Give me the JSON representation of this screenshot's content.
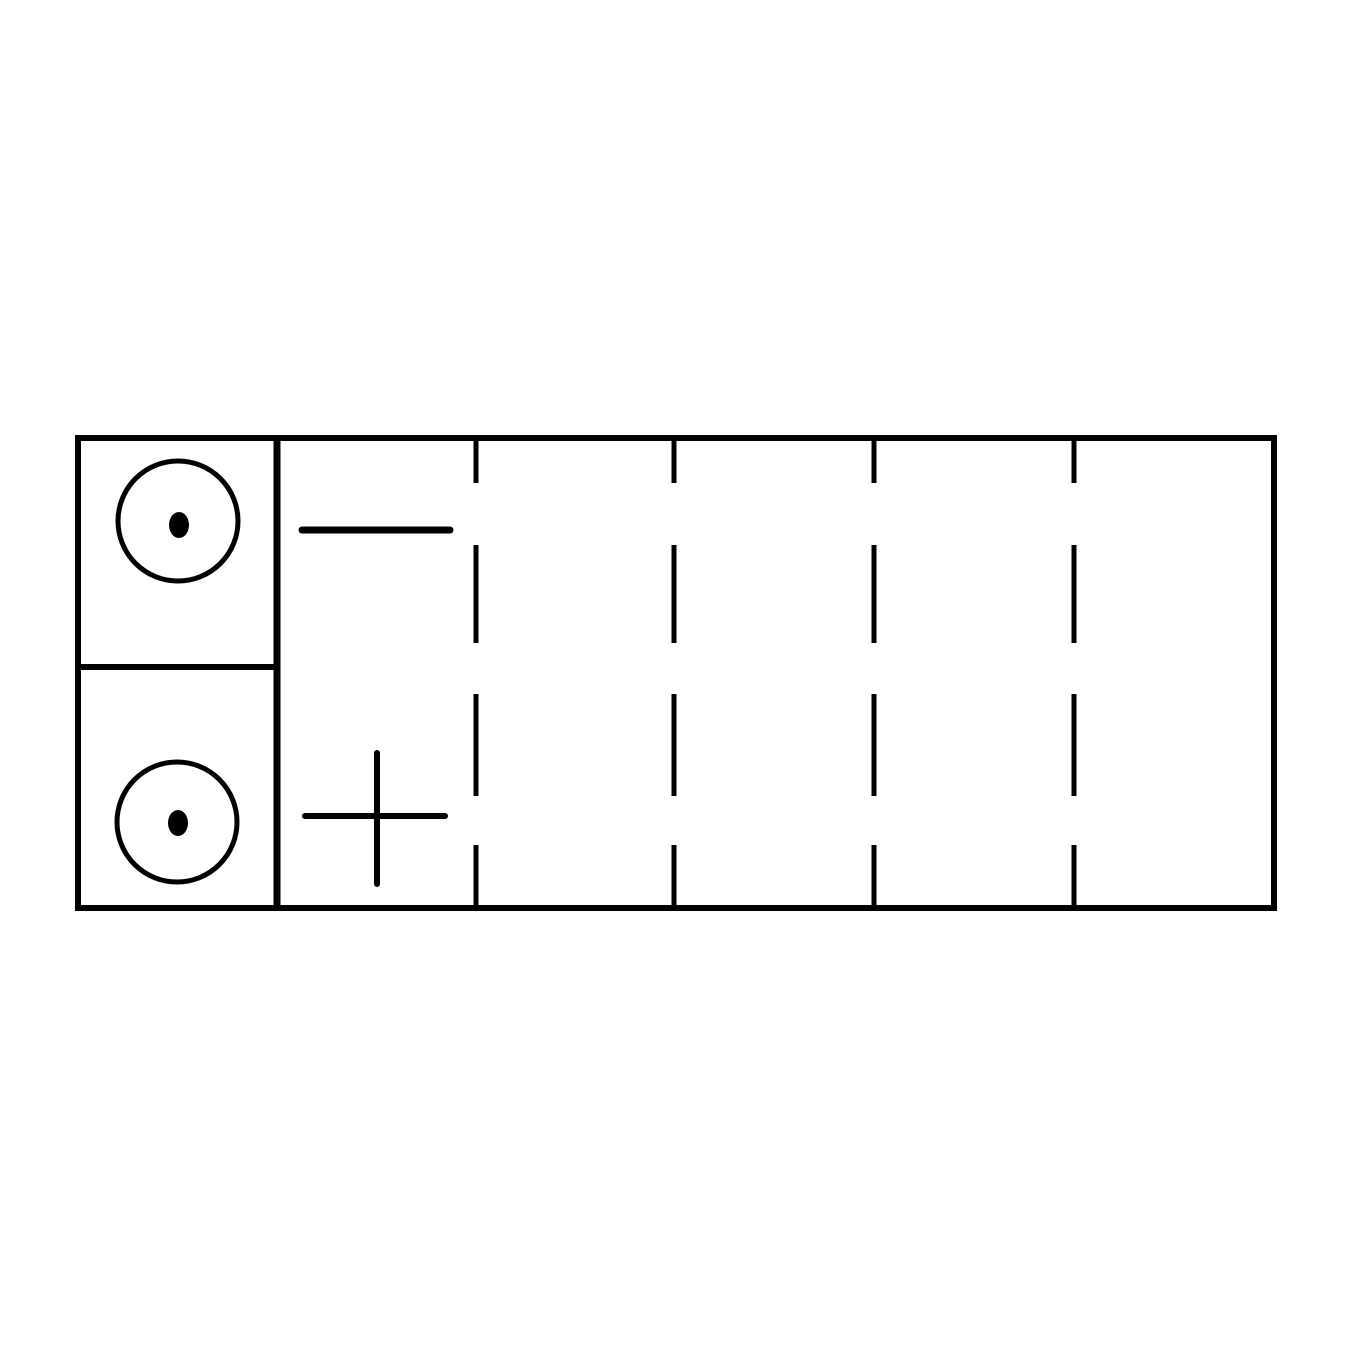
{
  "page": {
    "background_color": "#ffffff",
    "ink_color": "#000000"
  },
  "diagram": {
    "type": "battery-top-view-line-drawing",
    "canvas": {
      "width": 1350,
      "height": 1350
    },
    "outline": {
      "x": 78,
      "y": 438,
      "width": 1196,
      "height": 470,
      "stroke_width": 6
    },
    "terminal_block": {
      "right_edge_x": 277,
      "right_edge_stroke_width": 7,
      "divider_y": 667,
      "divider_stroke_width": 6
    },
    "terminals": [
      {
        "name": "negative-terminal",
        "polarity": "negative",
        "cx": 178,
        "cy": 521,
        "radius": 60,
        "stroke_width": 5,
        "dot_cx": 179,
        "dot_cy": 525,
        "dot_rx": 10,
        "dot_ry": 13
      },
      {
        "name": "positive-terminal",
        "polarity": "positive",
        "cx": 177,
        "cy": 822,
        "radius": 60,
        "stroke_width": 5,
        "dot_cx": 178,
        "dot_cy": 823,
        "dot_rx": 10,
        "dot_ry": 13
      }
    ],
    "polarity_symbols": {
      "minus": {
        "x1": 302,
        "x2": 450,
        "y": 530,
        "stroke_width": 7
      },
      "plus": {
        "h": {
          "x1": 305,
          "x2": 445,
          "y": 816
        },
        "v": {
          "x": 377,
          "y1": 753,
          "y2": 884
        },
        "stroke_width": 6
      }
    },
    "cell_dividers": {
      "x_positions": [
        476,
        674,
        874,
        1074
      ],
      "dash_segments": [
        [
          438,
          483
        ],
        [
          545,
          643
        ],
        [
          694,
          796
        ],
        [
          845,
          908
        ]
      ],
      "stroke_width": 5
    }
  }
}
